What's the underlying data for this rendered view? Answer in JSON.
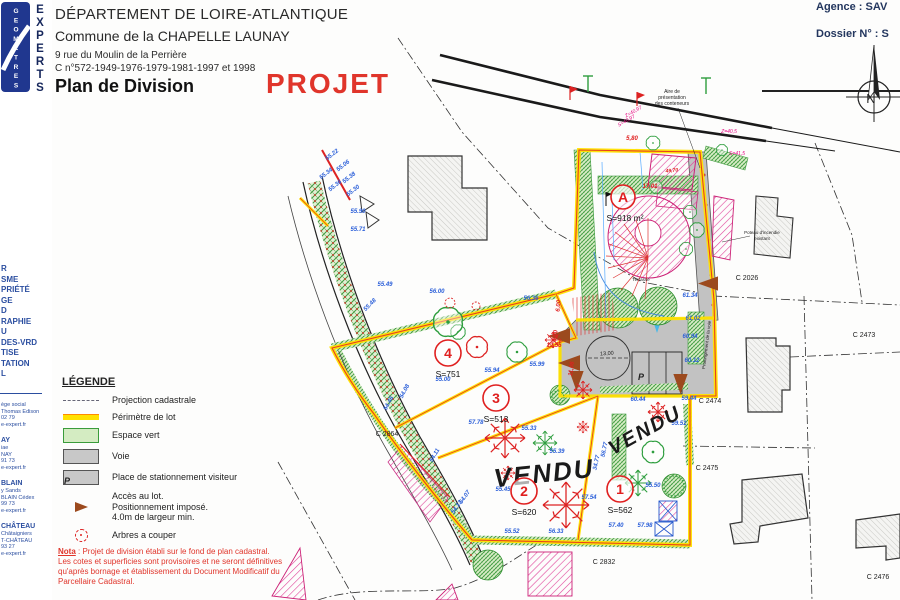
{
  "sidebar": {
    "logo_vertical": "GEOMETRES",
    "logo_experts": [
      "E",
      "X",
      "P",
      "E",
      "R",
      "T",
      "S"
    ],
    "services": [
      "R",
      "SME",
      "PRIÉTÉ",
      "GE",
      "D",
      "RAPHIE",
      "U",
      "DES-VRD",
      "TISE",
      "TATION",
      "L"
    ],
    "agencies": [
      {
        "title": "",
        "lines": [
          "ège social",
          "Thomas Edison",
          "02 79",
          "e-expert.fr"
        ]
      },
      {
        "title": "AY",
        "lines": [
          "iae",
          "NAY",
          "91 73",
          "e-expert.fr"
        ]
      },
      {
        "title": "BLAIN",
        "lines": [
          "y Sands",
          "BLAIN Cédex",
          "99 73",
          "e-expert.fr"
        ]
      },
      {
        "title": "CHÂTEAU",
        "lines": [
          "Châtaigniers",
          "T-CHÂTEAU",
          "93 27",
          "e-expert.fr"
        ]
      }
    ]
  },
  "header": {
    "line1": "DÉPARTEMENT DE LOIRE-ATLANTIQUE",
    "line2": "Commune de la CHAPELLE LAUNAY",
    "line3": "9 rue du Moulin de la Perrière",
    "line4": "C n°572-1949-1976-1979-1981-1997 et 1998",
    "title": "Plan de Division",
    "stamp": "PROJET",
    "agence": "Agence : SAV",
    "dossier": "Dossier N° : S"
  },
  "legend": {
    "title": "LÉGENDE",
    "items": [
      {
        "label": "Projection cadastrale"
      },
      {
        "label": "Périmètre de lot"
      },
      {
        "label": "Espace vert"
      },
      {
        "label": "Voie"
      },
      {
        "label": "Place de stationnement visiteur"
      },
      {
        "lines": [
          "Accès au lot.",
          "Positionnement imposé.",
          "4.0m de largeur min."
        ]
      },
      {
        "label": "Arbres a couper"
      }
    ],
    "p_swatch": "P"
  },
  "nota": {
    "label": "Nota",
    "line1": " : Projet de division établi sur le fond de plan cadastral.",
    "line2": "Les cotes et superficies sont provisoires et ne seront définitives",
    "line3": "qu'après bornage et établissement du Document Modificatif du",
    "line4": "Parcellaire Cadastral."
  },
  "plan": {
    "north": "N",
    "p_label": "P",
    "lots": [
      {
        "id": "A",
        "area": "S=918 m²",
        "cx": 623,
        "cy": 197,
        "r": 12,
        "ax": 625,
        "ay": 221,
        "as": 7
      },
      {
        "id": "4",
        "area": "S=751",
        "cx": 448,
        "cy": 353,
        "r": 13,
        "ax": 448,
        "ay": 377,
        "as": 8.5
      },
      {
        "id": "3",
        "area": "S=513",
        "cx": 496,
        "cy": 398,
        "r": 13,
        "ax": 496,
        "ay": 422,
        "as": 8.5
      },
      {
        "id": "2",
        "area": "S=620",
        "cx": 524,
        "cy": 491,
        "r": 13,
        "ax": 524,
        "ay": 515,
        "as": 8.5
      },
      {
        "id": "1",
        "area": "S=562",
        "cx": 620,
        "cy": 489,
        "r": 13,
        "ax": 620,
        "ay": 513,
        "as": 8.5
      }
    ],
    "parcels": [
      {
        "t": "C 2026",
        "x": 747,
        "y": 280
      },
      {
        "t": "C 2473",
        "x": 864,
        "y": 337
      },
      {
        "t": "C 2474",
        "x": 710,
        "y": 403
      },
      {
        "t": "C 2475",
        "x": 707,
        "y": 470
      },
      {
        "t": "C 2476",
        "x": 878,
        "y": 579
      },
      {
        "t": "C 2832",
        "x": 604,
        "y": 564
      },
      {
        "t": "C 2864",
        "x": 387,
        "y": 436
      }
    ],
    "vendu": [
      {
        "t": "VENDU",
        "x": 545,
        "y": 482,
        "r": -6,
        "s": 26
      },
      {
        "t": "VENDU",
        "x": 648,
        "y": 436,
        "r": -29,
        "s": 20
      }
    ],
    "elevations": [
      {
        "t": "55.22",
        "x": 333,
        "y": 156,
        "r": -38
      },
      {
        "t": "55.06",
        "x": 344,
        "y": 167,
        "r": -38
      },
      {
        "t": "55.34",
        "x": 327,
        "y": 175,
        "r": -38
      },
      {
        "t": "55.36",
        "x": 336,
        "y": 187,
        "r": -38
      },
      {
        "t": "55.38",
        "x": 350,
        "y": 179,
        "r": -38
      },
      {
        "t": "55.30",
        "x": 354,
        "y": 192,
        "r": -38
      },
      {
        "t": "55.90",
        "x": 358,
        "y": 213
      },
      {
        "t": "55.71",
        "x": 358,
        "y": 231
      },
      {
        "t": "55.48",
        "x": 371,
        "y": 306,
        "r": -45
      },
      {
        "t": "55.49",
        "x": 385,
        "y": 286
      },
      {
        "t": "56.00",
        "x": 437,
        "y": 293
      },
      {
        "t": "56.36",
        "x": 531,
        "y": 300
      },
      {
        "t": "55.94",
        "x": 492,
        "y": 372
      },
      {
        "t": "55.99",
        "x": 537,
        "y": 366
      },
      {
        "t": "55.00",
        "x": 443,
        "y": 381
      },
      {
        "t": "57.78",
        "x": 476,
        "y": 424
      },
      {
        "t": "55.33",
        "x": 529,
        "y": 430
      },
      {
        "t": "55.39",
        "x": 557,
        "y": 453
      },
      {
        "t": "55.45",
        "x": 503,
        "y": 491
      },
      {
        "t": "57.54",
        "x": 589,
        "y": 499
      },
      {
        "t": "55.50",
        "x": 653,
        "y": 487
      },
      {
        "t": "60.44",
        "x": 638,
        "y": 401
      },
      {
        "t": "59.51",
        "x": 679,
        "y": 425
      },
      {
        "t": "55.52",
        "x": 512,
        "y": 533
      },
      {
        "t": "56.33",
        "x": 556,
        "y": 533
      },
      {
        "t": "57.40",
        "x": 616,
        "y": 527
      },
      {
        "t": "57.98",
        "x": 645,
        "y": 527
      },
      {
        "t": "61.34",
        "x": 690,
        "y": 297
      },
      {
        "t": "61.02",
        "x": 693,
        "y": 320
      },
      {
        "t": "60.94",
        "x": 690,
        "y": 338
      },
      {
        "t": "60.12",
        "x": 692,
        "y": 362
      },
      {
        "t": "59.44",
        "x": 689,
        "y": 400
      },
      {
        "t": "54.13",
        "x": 458,
        "y": 508,
        "r": -55
      },
      {
        "t": "54.07",
        "x": 466,
        "y": 498,
        "r": -55
      },
      {
        "t": "54.11",
        "x": 436,
        "y": 456,
        "r": -60
      },
      {
        "t": "54.08",
        "x": 406,
        "y": 392,
        "r": -62
      },
      {
        "t": "54.46",
        "x": 390,
        "y": 404,
        "r": -62
      },
      {
        "t": "34.77",
        "x": 598,
        "y": 463,
        "r": -78
      },
      {
        "t": "56.77",
        "x": 606,
        "y": 450,
        "r": -78
      }
    ],
    "red_dims": [
      {
        "t": "5,80",
        "x": 632,
        "y": 140
      },
      {
        "t": "17,01",
        "x": 650,
        "y": 188
      },
      {
        "t": "11,06",
        "x": 573,
        "y": 369,
        "r": -82
      },
      {
        "t": "12,55",
        "x": 554,
        "y": 347
      },
      {
        "t": "6,00",
        "x": 560,
        "y": 306,
        "r": -85
      },
      {
        "t": "4,00",
        "x": 557,
        "y": 336,
        "r": -85
      },
      {
        "t": "49,70",
        "x": 672,
        "y": 172,
        "r": -6,
        "s": 5
      }
    ],
    "magenta_marks": [
      {
        "t": "Z=40,97",
        "x": 634,
        "y": 113,
        "r": -30
      },
      {
        "t": "S=40,97",
        "x": 627,
        "y": 122,
        "r": -30
      },
      {
        "t": "Z=40,5",
        "x": 729,
        "y": 133
      },
      {
        "t": "S=41,5",
        "x": 737,
        "y": 155
      }
    ],
    "notes": [
      {
        "t": "Aire de",
        "x": 672,
        "y": 93,
        "s": 5
      },
      {
        "t": "présentation",
        "x": 672,
        "y": 99,
        "s": 5
      },
      {
        "t": "des conteneurs",
        "x": 672,
        "y": 105,
        "s": 5
      },
      {
        "t": "Poteau d'incendie",
        "x": 762,
        "y": 234,
        "s": 4.5
      },
      {
        "t": "existant",
        "x": 762,
        "y": 240,
        "s": 4.5
      },
      {
        "t": "Terrasse",
        "x": 641,
        "y": 281,
        "s": 4.5
      },
      {
        "t": "13,00",
        "x": 607,
        "y": 355,
        "r": -4,
        "s": 5.5
      },
      {
        "t": "Prolongement de la voie",
        "x": 708,
        "y": 345,
        "r": -83,
        "s": 4.5
      }
    ]
  }
}
